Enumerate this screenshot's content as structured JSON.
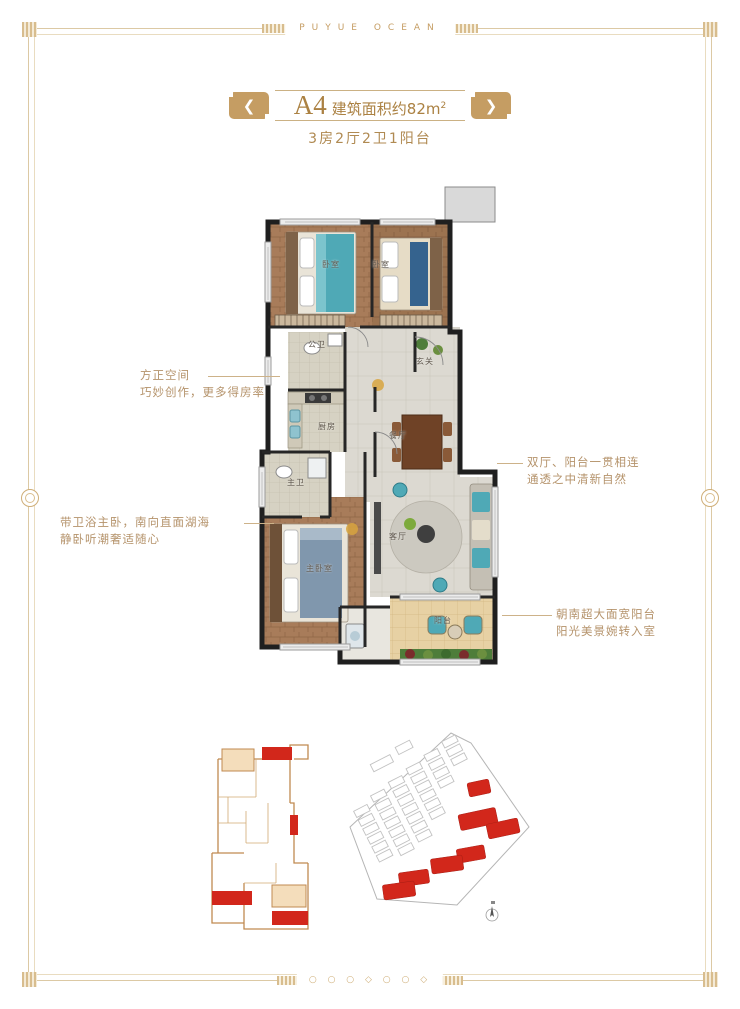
{
  "frame": {
    "brand_text": "PUYUE OCEAN",
    "bottom_ornament": "○ ○ ○ ◇ ○ ○ ◇"
  },
  "header": {
    "unit": "A4",
    "area_text": "建筑面积约82m",
    "area_sup": "2",
    "subtitle": "3房2厅2卫1阳台"
  },
  "floorplan": {
    "rooms": {
      "bedroom1": "卧室",
      "bedroom2": "卧室",
      "bath_public": "公卫",
      "foyer": "玄关",
      "kitchen": "厨房",
      "dining": "餐厅",
      "bath_master": "主卫",
      "master_bedroom": "主卧室",
      "living": "客厅",
      "balcony": "阳台"
    }
  },
  "annotations": {
    "left_top": {
      "line1": "方正空间",
      "line2": "巧妙创作，更多得房率"
    },
    "left_bottom": {
      "line1": "带卫浴主卧，南向直面湖海",
      "line2": "静卧听潮奢适随心"
    },
    "right_top": {
      "line1": "双厅、阳台一贯相连",
      "line2": "通透之中清新自然"
    },
    "right_bottom": {
      "line1": "朝南超大面宽阳台",
      "line2": "阳光美景婉转入室"
    }
  },
  "colors": {
    "accent_gold": "#c59d63",
    "text_gold": "#b08a52",
    "highlight_red": "#d2271b",
    "keyplan_tan": "#c08a50",
    "wall_black": "#1f1f1f",
    "teal_furniture": "#4fa9b6"
  }
}
